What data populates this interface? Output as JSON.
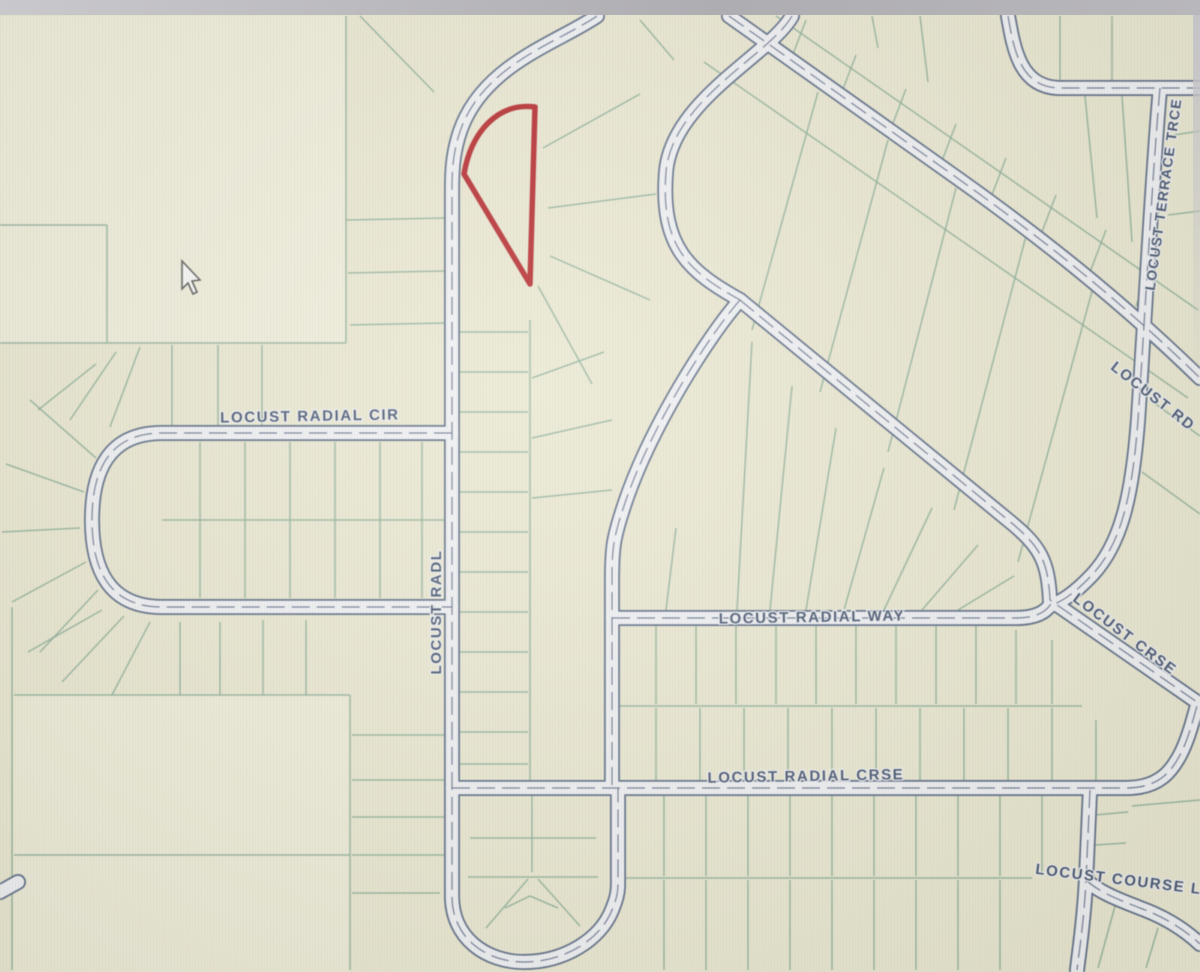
{
  "page": {
    "type": "parcel-map-viewer"
  },
  "top_bar": {
    "color": "#b6b5b9"
  },
  "map": {
    "background_color": "#e9e7d1",
    "parcel_line_color": "#8aab97",
    "road_fill_color": "#eff0f4",
    "road_casing_color": "#5d6c87",
    "road_centerline_color": "#4f5d7a",
    "street_label_color": "#45536f",
    "highlight_parcel_color": "#b4262b",
    "street_labels": {
      "radial_cir": "LOCUST RADIAL CIR",
      "radl": "LOCUST RADL",
      "radial_way": "LOCUST RADIAL WAY",
      "radial_crse": "LOCUST RADIAL CRSE",
      "terrace_trce": "LOCUST TERRACE TRCE",
      "rd": "LOCUST RD",
      "crse": "LOCUST CRSE",
      "course": "LOCUST COURSE L"
    },
    "cursor": {
      "x": 182,
      "y": 261
    }
  }
}
